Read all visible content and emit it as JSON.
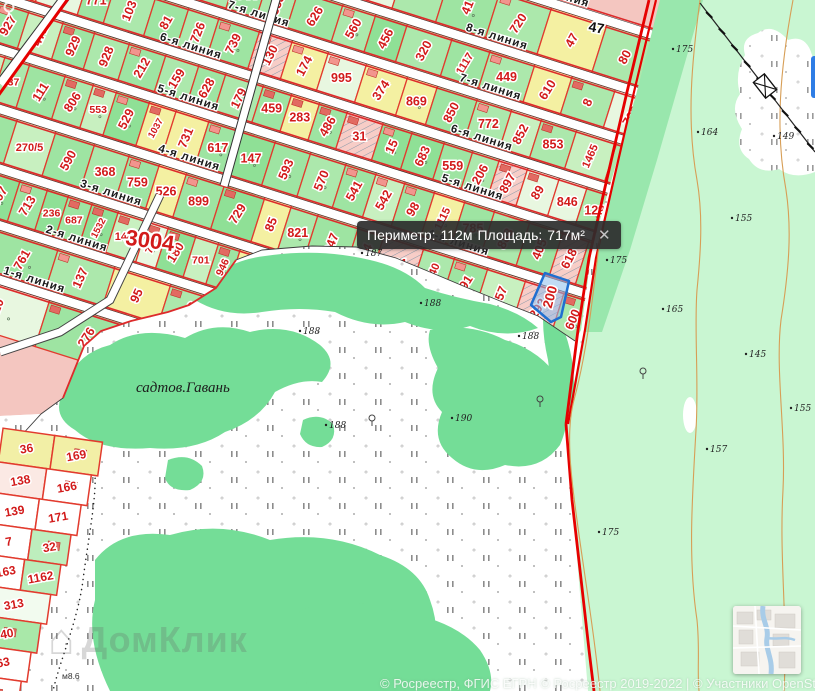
{
  "map": {
    "tooltip": {
      "perimeter_label": "Периметр:",
      "perimeter_value": "112м",
      "area_label": "Площадь:",
      "area_value": "717м²",
      "close": "✕"
    },
    "selected_parcel": {
      "number": "200"
    },
    "quarter_label": "3004",
    "place_label": "садтов.Гавань",
    "label_47": "47",
    "bridge_label": "м8.6",
    "watermark": "ДомКлик",
    "watermark_icon": "⌂",
    "attribution": "© Росреестр, ФГИС ЕГРН © Росреестр 2019-2022 | © Участники OpenStreetMap",
    "colors": {
      "parcel_line": "#e23b2e",
      "number": "#d21a1a",
      "selection": "#1f6fd0",
      "boundary_red": "#e60000",
      "forest_pale": "#c9f6d2",
      "forest_mid": "#99e7ad",
      "blob_green": "#74dd97",
      "block_pink": "#f4c6c0",
      "contour": "#d79e56"
    },
    "streets": [
      {
        "name": "9-я линия",
        "label_u": [
          531
        ]
      },
      {
        "name": "8-я линия",
        "label_u": [
          485
        ]
      },
      {
        "name": "7-я линия",
        "label_u": [
          251,
          494
        ]
      },
      {
        "name": "6-я линия",
        "label_u": [
          196,
          501
        ]
      },
      {
        "name": "5-я линия",
        "label_u": [
          209,
          507
        ]
      },
      {
        "name": "4-я линия",
        "label_u": [
          228,
          510
        ]
      },
      {
        "name": "3-я линия",
        "label_u": [
          164
        ]
      },
      {
        "name": "2-я линия",
        "label_u": [
          145
        ]
      },
      {
        "name": "1-я линия",
        "label_u": [
          117
        ]
      }
    ],
    "bands": [
      [
        "46",
        "246",
        "75",
        "397",
        "952",
        "753"
      ],
      [
        "306",
        "760",
        "820",
        "222",
        "1462",
        "241",
        "756",
        "401",
        "355",
        "272",
        "41",
        "720",
        "47",
        "80"
      ],
      [
        "562",
        "4",
        "414",
        "945",
        "1463",
        "480",
        "905",
        "833",
        "944",
        "353",
        "626",
        "560",
        "456",
        "320",
        "1117",
        "449",
        "610",
        "8",
        "702"
      ],
      [
        "45",
        "327",
        "301",
        "815",
        "771",
        "103",
        "81",
        "726",
        "739",
        "130",
        "174",
        "995",
        "374",
        "869",
        "850",
        "772",
        "852",
        "853",
        "1465",
        "737"
      ],
      [
        "9",
        "201",
        "927",
        "471",
        "929",
        "928",
        "212",
        "159",
        "628",
        "179",
        "459",
        "283",
        "486",
        "31",
        "15",
        "683",
        "559",
        "206",
        "897",
        "89",
        "846",
        "129",
        "22"
      ],
      [
        "19",
        "698",
        "126",
        "637",
        "111",
        "806",
        "553",
        "529",
        "1037",
        "731",
        "617",
        "147",
        "593",
        "570",
        "541",
        "542",
        "98",
        "1115",
        "785",
        "888",
        "405",
        "618",
        "798",
        "475"
      ],
      [
        "91",
        "234",
        "569",
        "270/5",
        "590",
        "368",
        "759",
        "526",
        "899",
        "729",
        "85",
        "821",
        "347",
        "164",
        "621",
        "1540",
        "291",
        "757",
        "292",
        "600",
        "751"
      ],
      [
        "699",
        "343",
        "187",
        "807",
        "713",
        "236",
        "687",
        "1532",
        "1446",
        "708",
        "180",
        "701",
        "946",
        "825",
        "1061",
        "240",
        "97",
        "539"
      ],
      [
        "257",
        "809",
        "761",
        "137",
        "95",
        "392"
      ],
      [
        "778",
        "120",
        "276"
      ]
    ],
    "lower_block_rows": [
      [
        "36",
        "169"
      ],
      [
        "138",
        "166"
      ],
      [
        "139",
        "171"
      ],
      [
        "7",
        "32"
      ],
      [
        "1163",
        "1162"
      ],
      [
        "313"
      ],
      [
        "40"
      ],
      [
        "263"
      ],
      [
        "69"
      ]
    ],
    "elevations": [
      {
        "x": 365,
        "y": 256,
        "v": "187"
      },
      {
        "x": 303,
        "y": 334,
        "v": "188"
      },
      {
        "x": 424,
        "y": 306,
        "v": "188"
      },
      {
        "x": 522,
        "y": 339,
        "v": "188"
      },
      {
        "x": 455,
        "y": 421,
        "v": "190"
      },
      {
        "x": 329,
        "y": 428,
        "v": "188"
      },
      {
        "x": 676,
        "y": 52,
        "v": "175"
      },
      {
        "x": 701,
        "y": 135,
        "v": "164"
      },
      {
        "x": 777,
        "y": 139,
        "v": "149"
      },
      {
        "x": 735,
        "y": 221,
        "v": "155"
      },
      {
        "x": 610,
        "y": 263,
        "v": "175"
      },
      {
        "x": 666,
        "y": 312,
        "v": "165"
      },
      {
        "x": 749,
        "y": 357,
        "v": "145"
      },
      {
        "x": 794,
        "y": 411,
        "v": "155"
      },
      {
        "x": 710,
        "y": 452,
        "v": "157"
      },
      {
        "x": 602,
        "y": 535,
        "v": "175"
      },
      {
        "x": 751,
        "y": 634,
        "v": "185"
      }
    ],
    "springs": [
      {
        "x": 372,
        "y": 418
      },
      {
        "x": 540,
        "y": 399
      },
      {
        "x": 643,
        "y": 371
      }
    ]
  }
}
